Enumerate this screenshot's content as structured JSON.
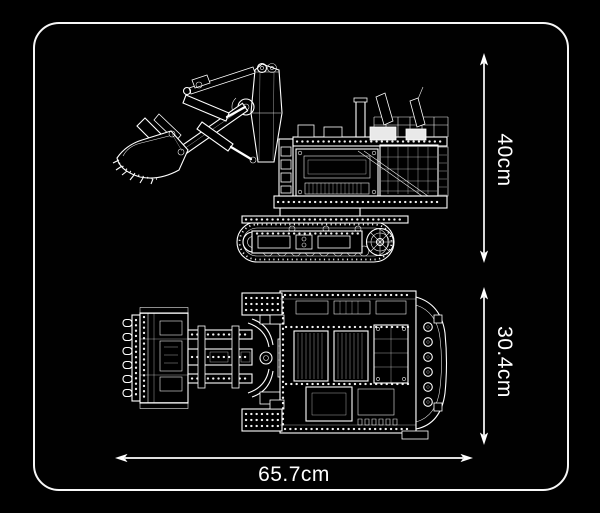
{
  "card": {
    "background": "#000000",
    "border_color": "#f7f7f7",
    "line_color": "#ffffff"
  },
  "dimensions": {
    "height": "40cm",
    "depth": "30.4cm",
    "length": "65.7cm"
  }
}
